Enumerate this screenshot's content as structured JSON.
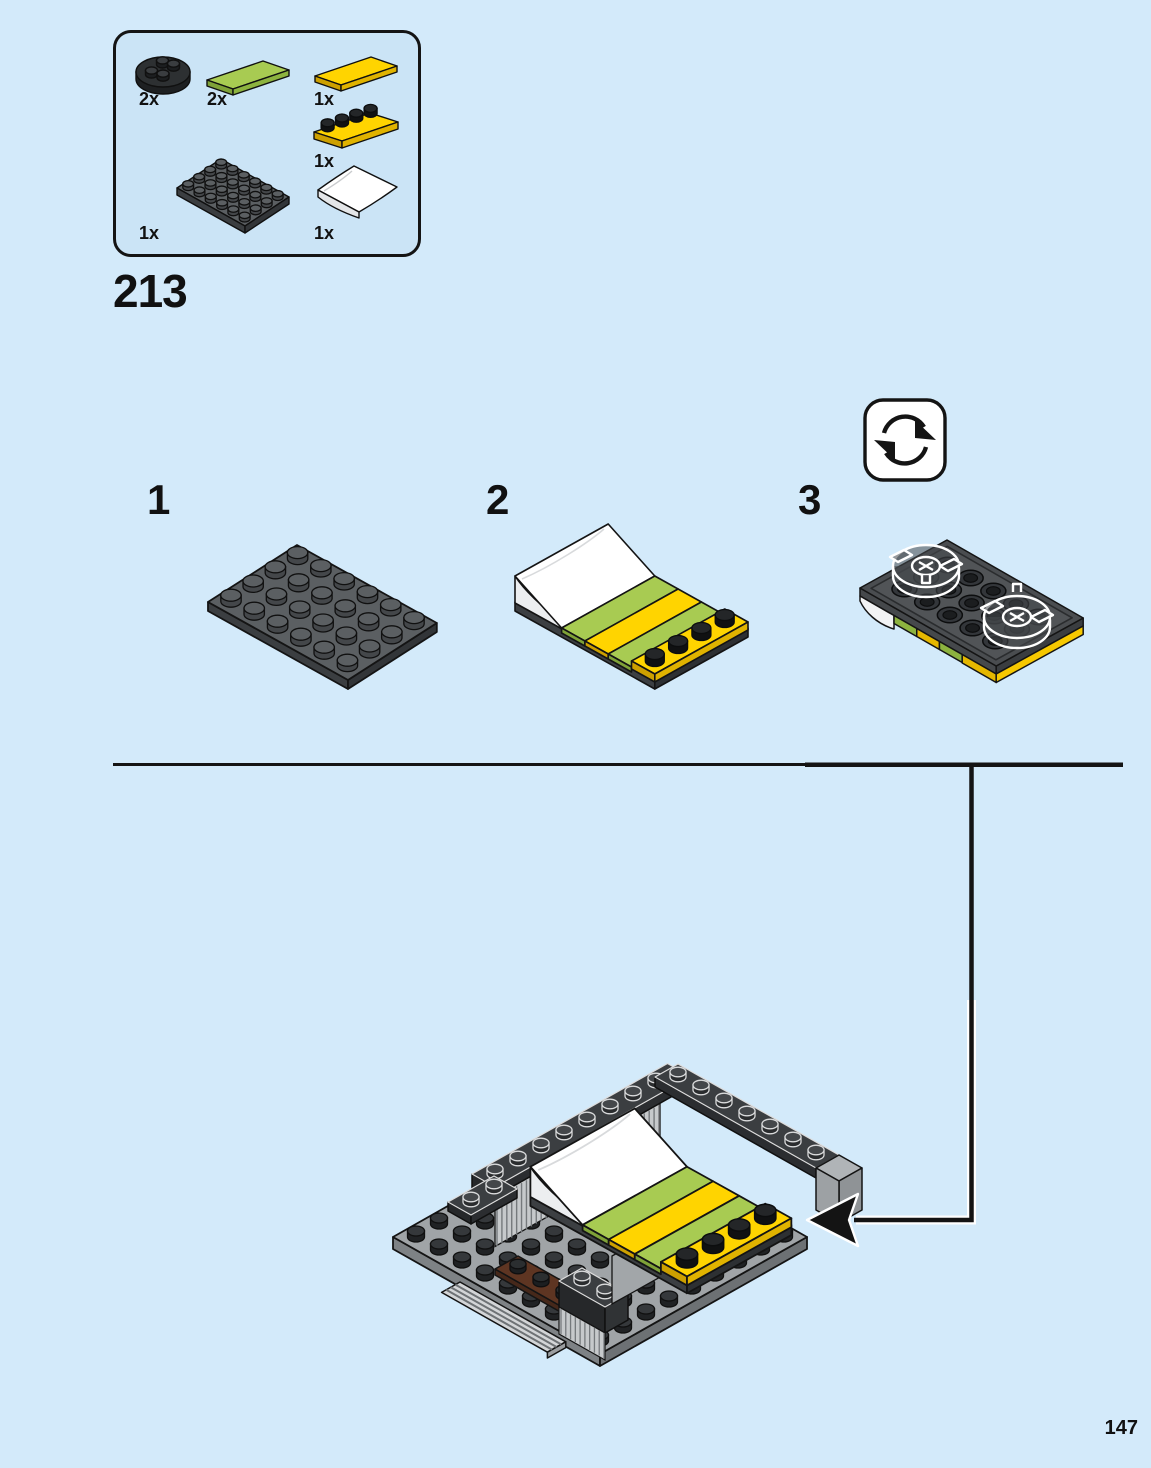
{
  "page": {
    "step_number": "213",
    "page_number": "147",
    "background_color": "#d3eafa"
  },
  "parts_box": {
    "parts": [
      {
        "name": "plate-round-2x2-black",
        "count_label": "2x",
        "color": "#2e3133"
      },
      {
        "name": "tile-1x4-lime",
        "count_label": "2x",
        "color": "#a8cb52"
      },
      {
        "name": "tile-1x4-yellow",
        "count_label": "1x",
        "color": "#ffd400"
      },
      {
        "name": "plate-1x4-yellow",
        "count_label": "1x",
        "color": "#ffd400"
      },
      {
        "name": "plate-4x6-dark-gray",
        "count_label": "1x",
        "color": "#5b5f62"
      },
      {
        "name": "slope-curved-2x4-white",
        "count_label": "1x",
        "color": "#ffffff"
      }
    ]
  },
  "steps": [
    {
      "label": "1"
    },
    {
      "label": "2"
    },
    {
      "label": "3"
    }
  ],
  "icons": {
    "rotate_model_icon": "two circular arrows meaning rotate the assembly",
    "callout_arrow_icon": "black arrow showing where sub-assembly attaches"
  },
  "colors": {
    "background": "#d3eafa",
    "callout_fill": "#cbe4f6",
    "line": "#141414",
    "lime": "#a8cb52",
    "yellow": "#ffd400",
    "dark_gray": "#5b5f62",
    "light_gray": "#a0a4a7",
    "brown": "#5e3522",
    "white": "#ffffff"
  }
}
